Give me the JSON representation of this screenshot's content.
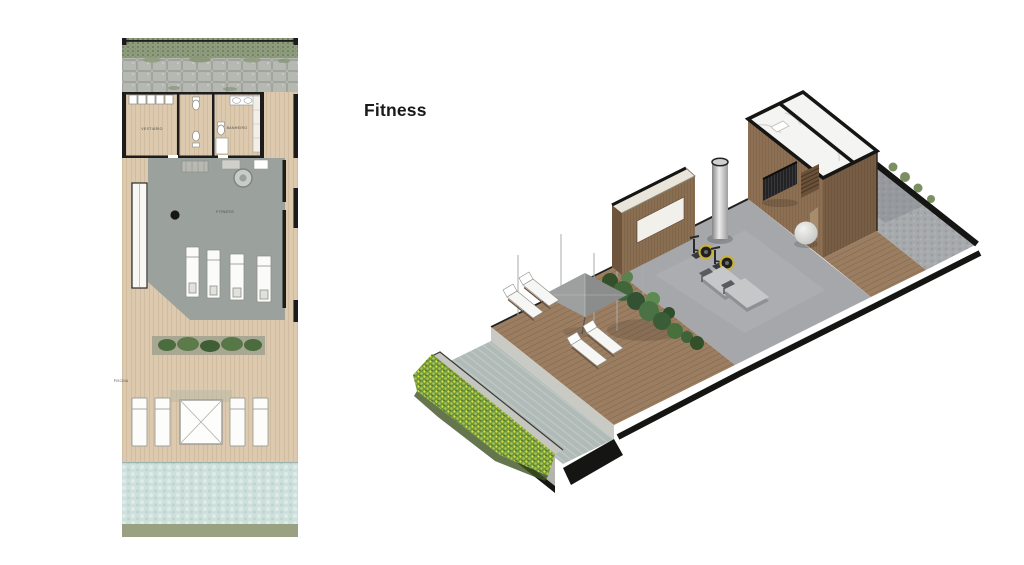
{
  "page": {
    "background": "#ffffff",
    "heading": "Fitness"
  },
  "floor_plan": {
    "labels": {
      "vestiario": "VESTIÁRIO",
      "banheiro": "BANHEIRO",
      "fitness": "FITNESS",
      "piscina": "PISCINA"
    }
  },
  "colors": {
    "page_bg": "#ffffff",
    "heading_color": "#1a1a1a",
    "plan_wood": "#dcc9ae",
    "plan_hedge": "#8f9d7e",
    "plan_stone": "#b6b8b2",
    "plan_fitness_floor": "#9ba19c",
    "plan_pool": "#cde0dc",
    "plan_green_strip": "#9aa183",
    "iso_gym_floor": "#a5a7ab",
    "iso_deck": "#9b7e61",
    "iso_pool": "#b0bab7",
    "iso_pool_wall": "#c9cac4",
    "iso_rim": "#c6c6c0",
    "iso_stone": "#a7aaad",
    "iso_wood_face_light": "#8d7053",
    "iso_wood_face_dark": "#775d43",
    "iso_wall_wood": "#8a6e52",
    "iso_wall_end": "#6e543c",
    "iso_marble": "#f4f4f2",
    "iso_vegetation": "#6f9440",
    "outline_black": "#151513"
  }
}
